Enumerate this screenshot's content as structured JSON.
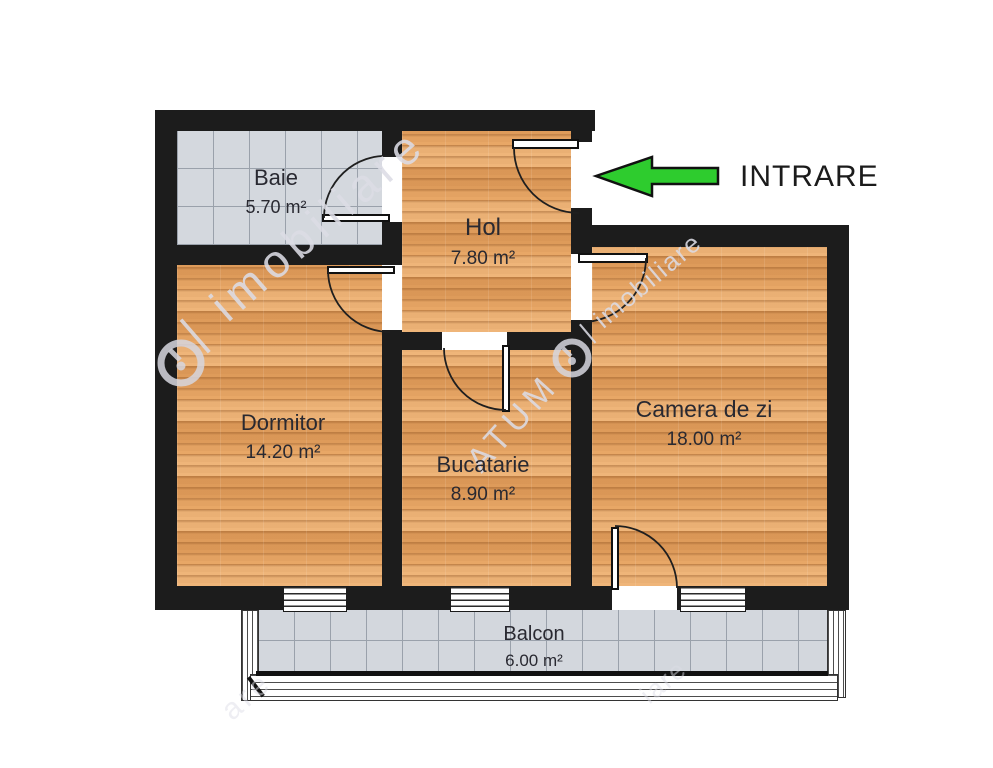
{
  "rooms": {
    "baie": {
      "name": "Baie",
      "area": "5.70 m²"
    },
    "hol": {
      "name": "Hol",
      "area": "7.80 m²"
    },
    "dormitor": {
      "name": "Dormitor",
      "area": "14.20 m²"
    },
    "bucatarie": {
      "name": "Bucatarie",
      "area": "8.90 m²"
    },
    "camera_de_zi": {
      "name": "Camera de zi",
      "area": "18.00 m²"
    },
    "balcon": {
      "name": "Balcon",
      "area": "6.00 m²"
    }
  },
  "entrance": {
    "label": "INTRARE",
    "arrow_direction": "left"
  },
  "watermarks": {
    "left_text": "| imobiliare",
    "right_text": "| imobiliare",
    "agency_text": "ATUM",
    "fragment_bottom_left": "are",
    "fragment_bottom_right": "iare"
  },
  "colors": {
    "wall": "#1c1c1c",
    "wood_floor": "#e8a766",
    "tile_floor": "#d4d8de",
    "arrow_green": "#2ecc2e",
    "label_text": "#292931"
  }
}
